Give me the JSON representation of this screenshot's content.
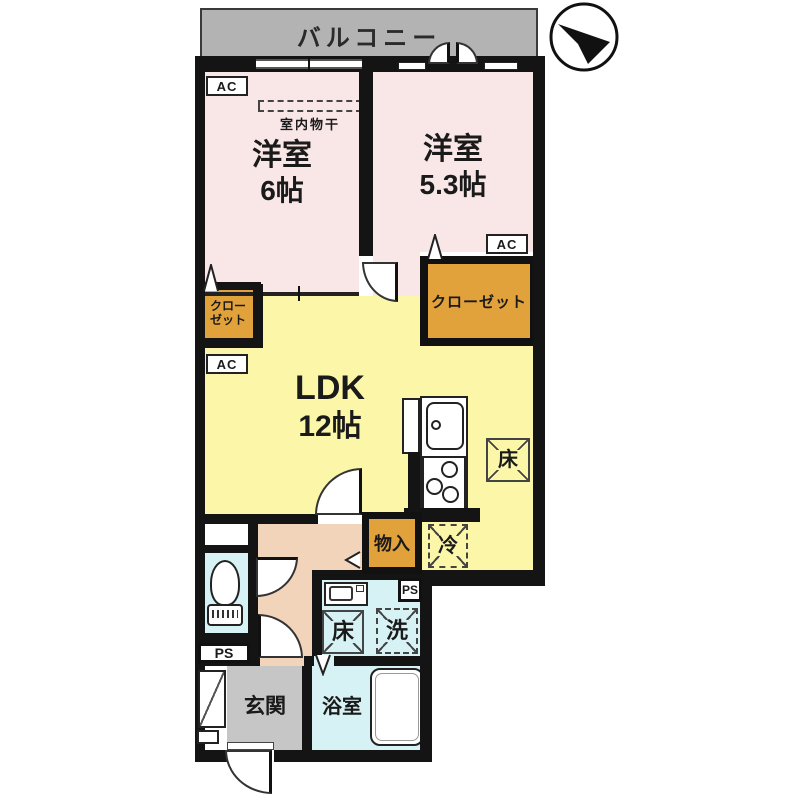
{
  "colors": {
    "wall": "#141414",
    "room_pink": "#f9e7e7",
    "ldk_yellow": "#fbf6a8",
    "closet_orange": "#e2a23b",
    "hall_peach": "#f2d4bb",
    "wet_cyan": "#d7f2f5",
    "balcony_gray": "#b3b3b3",
    "entrance_gray": "#c6c6c6"
  },
  "balcony": {
    "label": "バルコニー"
  },
  "rooms": {
    "western6": {
      "name": "洋室",
      "size": "6帖",
      "ac_label": "AC",
      "drying_label": "室内物干"
    },
    "western53": {
      "name": "洋室",
      "size": "5.3帖",
      "ac_label": "AC"
    },
    "ldk": {
      "name": "LDK",
      "size": "12帖",
      "ac_label": "AC"
    },
    "closet_left": {
      "line1": "クロー",
      "line2": "ゼット"
    },
    "closet_right": {
      "label": "クローゼット"
    },
    "storage": {
      "label": "物入"
    },
    "entrance": {
      "label": "玄関"
    },
    "bathroom": {
      "label": "浴室"
    }
  },
  "fixtures": {
    "floor_hatch_ldk": "床",
    "fridge": "冷",
    "floor_hatch_wash": "床",
    "washer": "洗",
    "ps_toilet": "PS",
    "ps_wash": "PS"
  }
}
